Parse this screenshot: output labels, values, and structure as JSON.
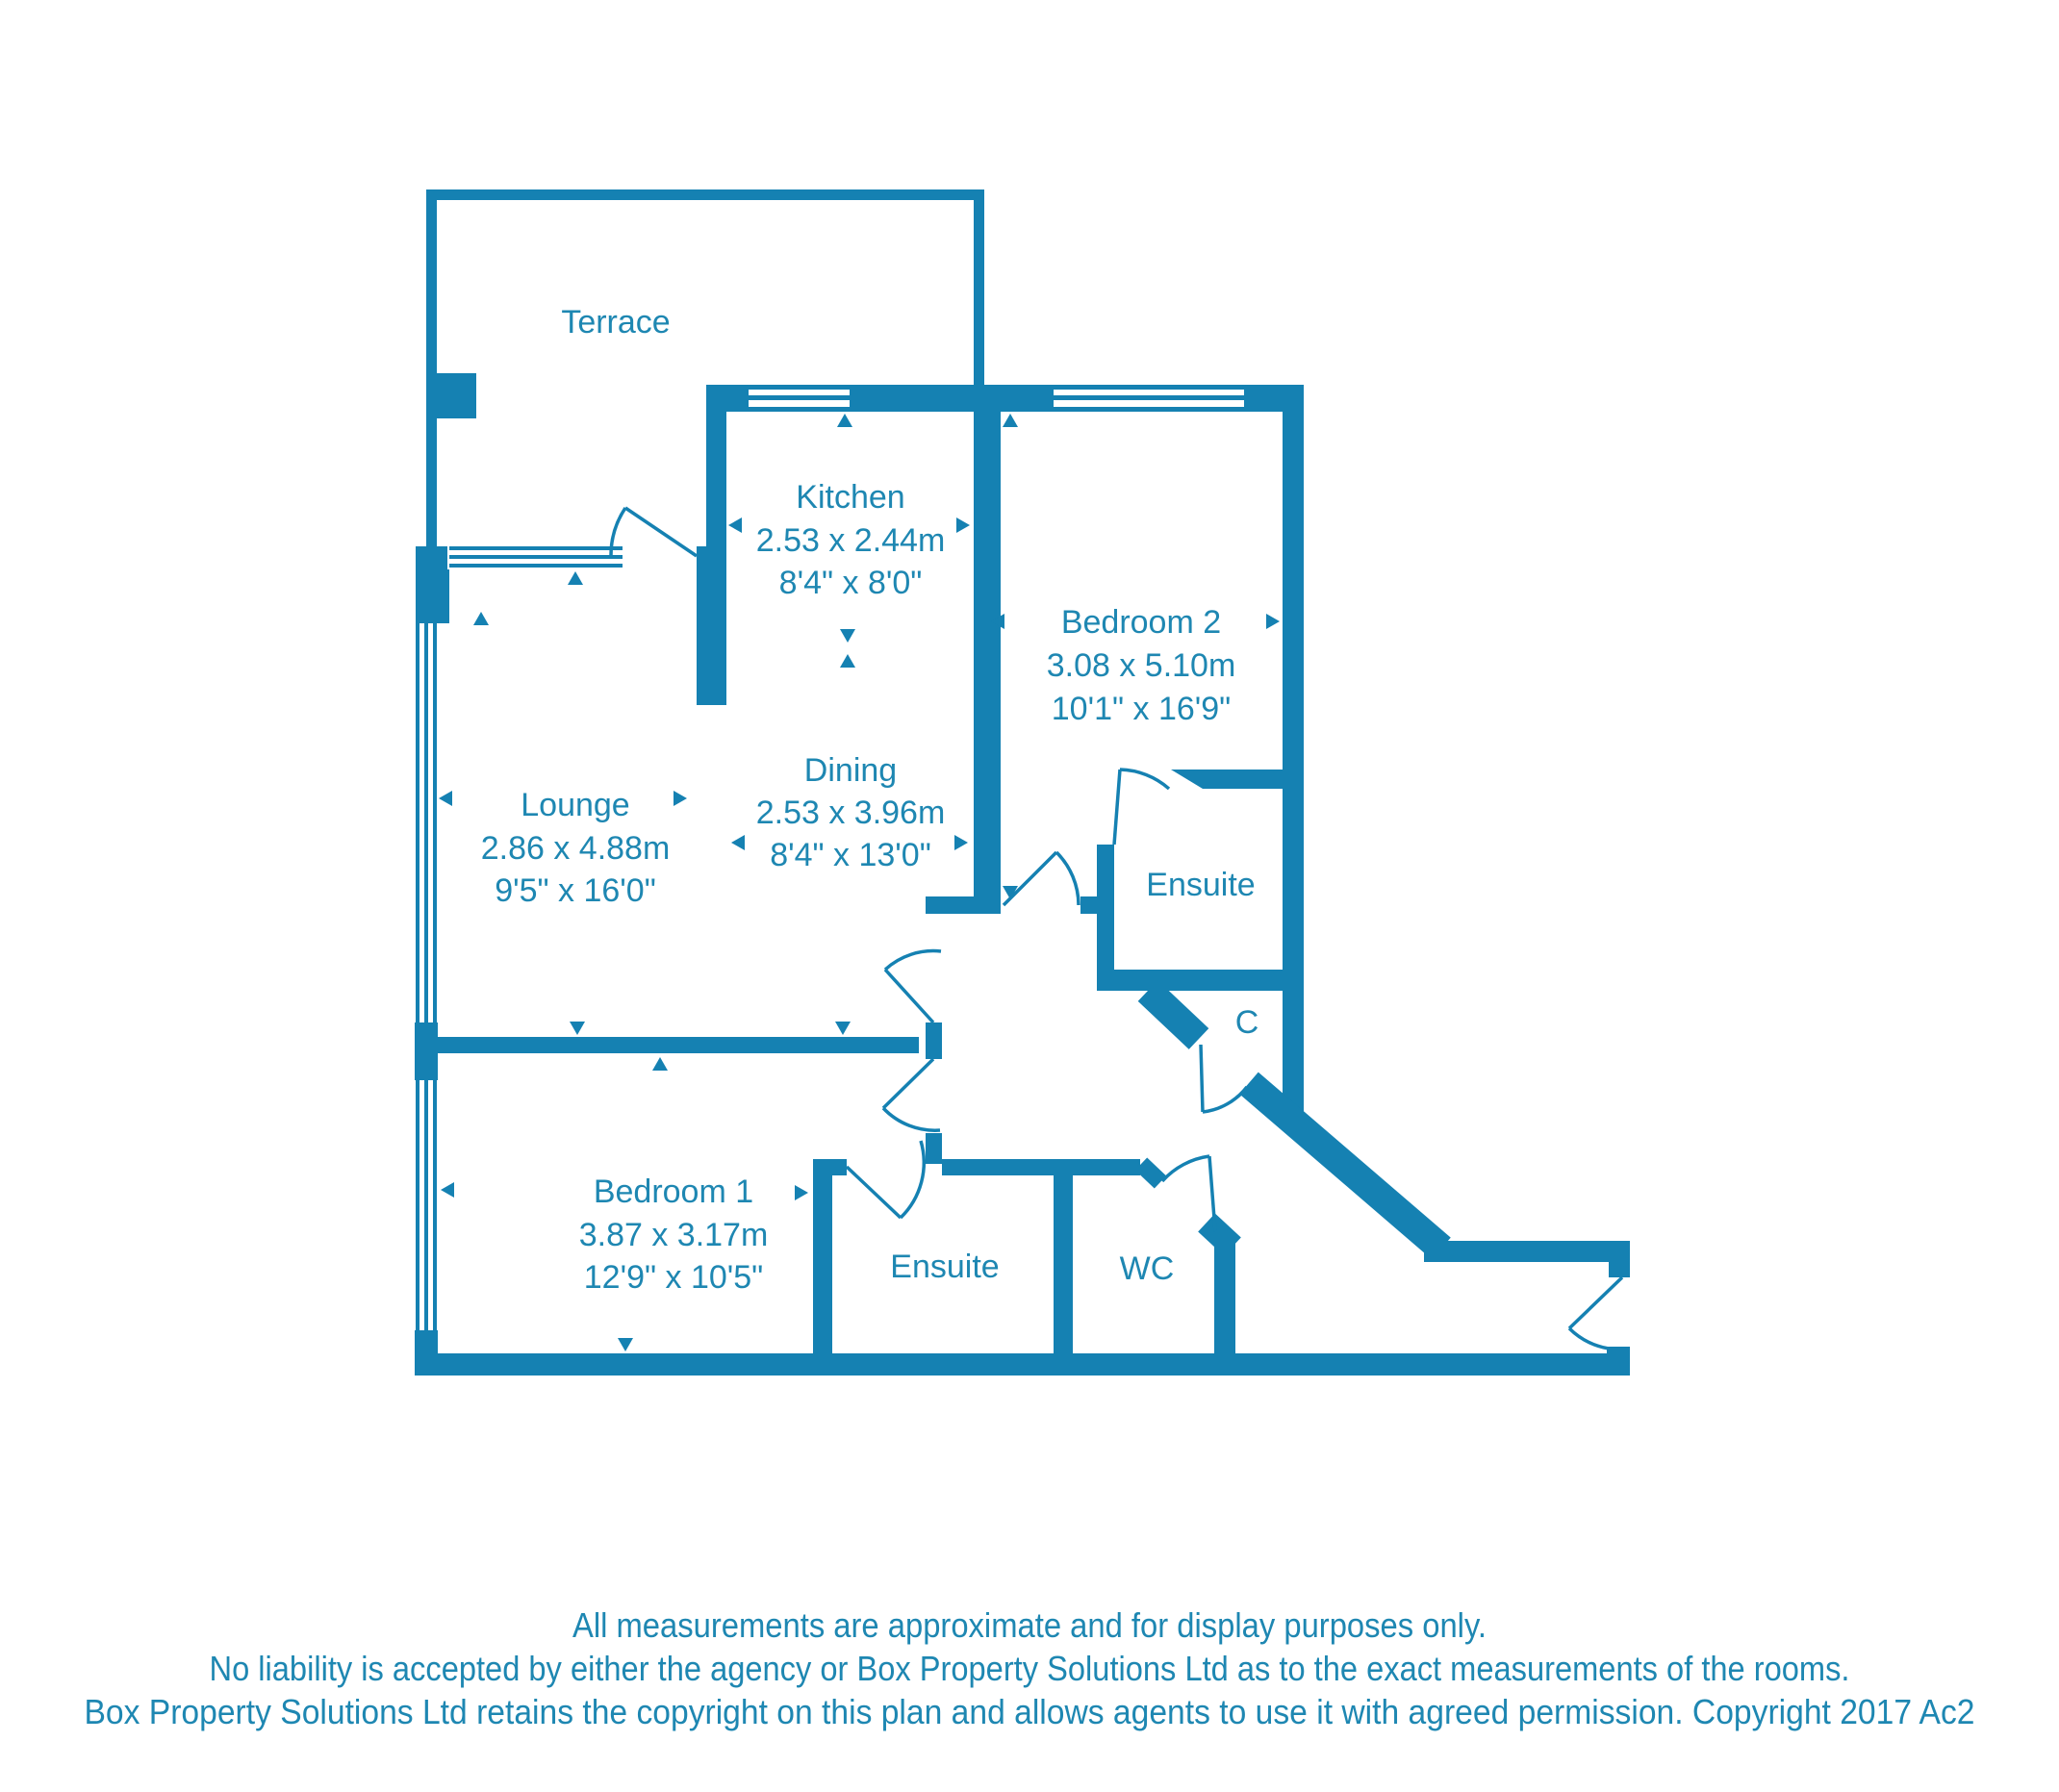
{
  "colors": {
    "wall": "#1581b2",
    "text": "#1e87b2"
  },
  "rooms": {
    "terrace": {
      "label": "Terrace"
    },
    "kitchen": {
      "label": "Kitchen",
      "metric": "2.53 x 2.44m",
      "imperial": "8'4\" x 8'0\""
    },
    "bedroom2": {
      "label": "Bedroom 2",
      "metric": "3.08 x 5.10m",
      "imperial": "10'1\" x 16'9\""
    },
    "lounge": {
      "label": "Lounge",
      "metric": "2.86 x 4.88m",
      "imperial": "9'5\" x 16'0\""
    },
    "dining": {
      "label": "Dining",
      "metric": "2.53 x 3.96m",
      "imperial": "8'4\" x 13'0\""
    },
    "ensuite2": {
      "label": "Ensuite"
    },
    "closet": {
      "label": "C"
    },
    "bedroom1": {
      "label": "Bedroom 1",
      "metric": "3.87 x 3.17m",
      "imperial": "12'9\" x 10'5\""
    },
    "ensuite1": {
      "label": "Ensuite"
    },
    "wc": {
      "label": "WC"
    }
  },
  "disclaimer": {
    "line1": "All measurements are approximate and for display purposes only.",
    "line2": "No liability is accepted by either the agency or Box Property Solutions Ltd as to the exact measurements of the rooms.",
    "line3": "Box Property Solutions Ltd retains the copyright on this plan and allows agents to use it with agreed permission. Copyright 2017 Ac2"
  }
}
